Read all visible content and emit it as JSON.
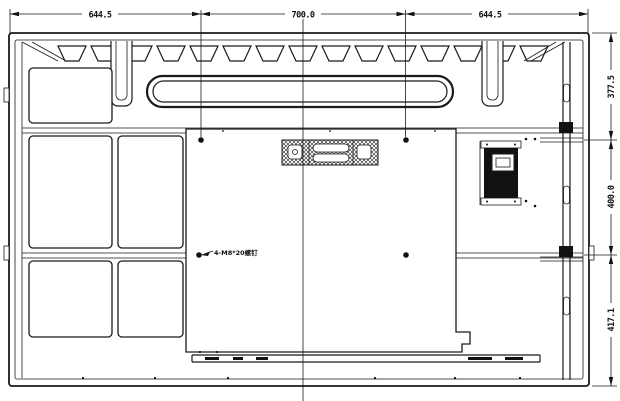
{
  "drawing": {
    "type": "technical-drawing",
    "subject": "display-rear-panel-view",
    "colors": {
      "line": "#1a1a1a",
      "background": "#ffffff"
    },
    "dimensions": {
      "top": [
        {
          "label": "644.5"
        },
        {
          "label": "700.0"
        },
        {
          "label": "644.5"
        }
      ],
      "right": [
        {
          "label": "377.5"
        },
        {
          "label": "400.0"
        },
        {
          "label": "417.1"
        }
      ]
    },
    "annotations": {
      "vesa_screws": "4-M8*20螺钉"
    }
  }
}
